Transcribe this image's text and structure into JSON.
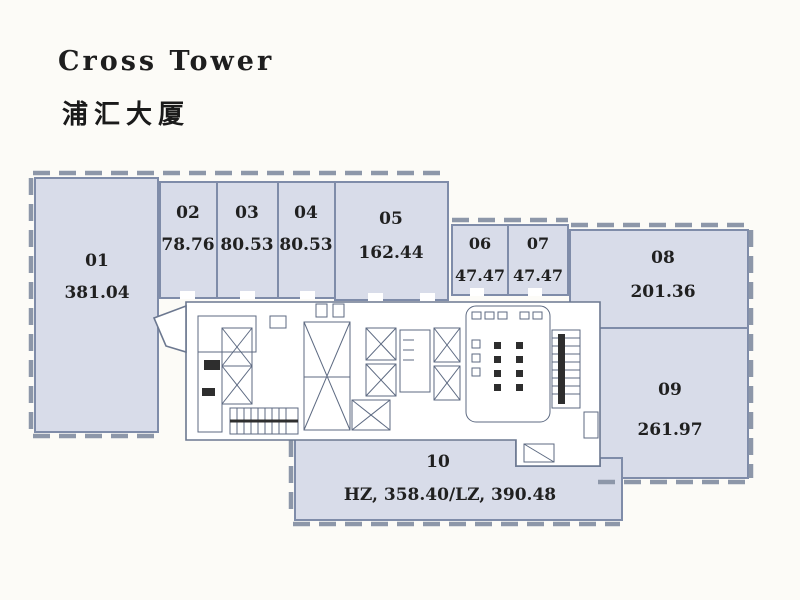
{
  "header": {
    "title_en": "Cross Tower",
    "title_zh": "浦汇大厦"
  },
  "floor_plan": {
    "units": {
      "u01": {
        "id": "01",
        "area": "381.04"
      },
      "u02": {
        "id": "02",
        "area": "78.76"
      },
      "u03": {
        "id": "03",
        "area": "80.53"
      },
      "u04": {
        "id": "04",
        "area": "80.53"
      },
      "u05": {
        "id": "05",
        "area": "162.44"
      },
      "u06": {
        "id": "06",
        "area": "47.47"
      },
      "u07": {
        "id": "07",
        "area": "47.47"
      },
      "u08": {
        "id": "08",
        "area": "201.36"
      },
      "u09": {
        "id": "09",
        "area": "261.97"
      },
      "u10": {
        "id": "10",
        "area": "HZ, 358.40/LZ, 390.48"
      }
    },
    "colors": {
      "unit_fill": "#d8dce9",
      "unit_border": "#7f8ca9",
      "facade_dash": "#8d97a9",
      "core_line": "#5d6a82",
      "label_text": "#202020",
      "background": "#fcfbf7"
    }
  }
}
